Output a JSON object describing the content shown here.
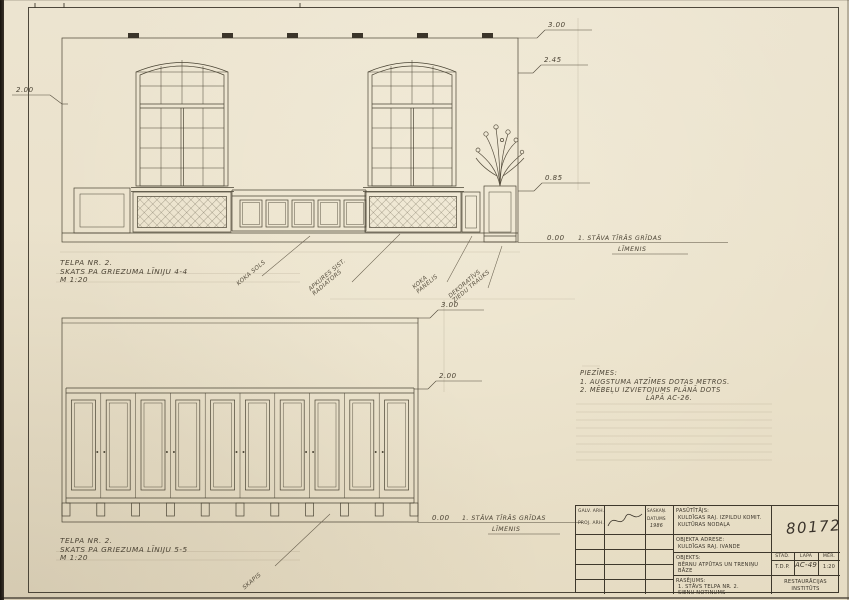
{
  "sheet": {
    "bg": "#ebe2cd",
    "ink": "#3e382c",
    "pencil": "#564e3e"
  },
  "top_view": {
    "title1": "TELPA NR. 2.",
    "title2": "SKATS PA GRIEZUMA LĪNIJU 4-4",
    "title3": "M 1:20",
    "lvl_top": "3.00",
    "lvl_lintel": "2.45",
    "lvl_sill": "0.85",
    "lvl_floor": "0.00",
    "lvl_left": "2.00",
    "floor_text": "1. STĀVA TĪRĀS GRĪDAS",
    "floor_text2": "LĪMENIS",
    "callout1": "KOKA SOLS",
    "callout2a": "APKURES SIST.",
    "callout2b": "RADIATORS",
    "callout3a": "KOKA",
    "callout3b": "PANELIS",
    "callout4a": "DEKORATĪVS",
    "callout4b": "ZIEDU TRAUKS"
  },
  "bottom_view": {
    "title1": "TELPA NR. 2.",
    "title2": "SKATS PA GRIEZUMA LĪNIJU 5-5",
    "title3": "M 1:20",
    "lvl_top": "3.00",
    "lvl_cab": "2.00",
    "lvl_floor": "0.00",
    "floor_text": "1. STĀVA TĪRĀS GRĪDAS",
    "floor_text2": "LĪMENIS",
    "callout": "SKAPIS"
  },
  "notes": {
    "heading": "PIEZĪMES:",
    "n1": "1. AUGSTUMA ATZĪMES DOTAS METROS.",
    "n2": "2. MĒBEĻU IZVIETOJUMS PLĀNĀ DOTS",
    "n3": "LAPĀ AC-26."
  },
  "titleblock": {
    "role1": "GALV. ARH.",
    "role2": "PROJ. ARH.",
    "approve1": "SASKAŅ.",
    "approve2": "DATUMS",
    "year": "1986",
    "client_label": "PASŪTĪTĀJS:",
    "client1": "KULDĪGAS RAJ. IZPILDU KOMIT.",
    "client2": "KULTŪRAS NODAĻA",
    "addr_label": "OBJEKTA ADRESE:",
    "addr1": "KULDĪGAS RAJ. IVANDE",
    "obj_label": "OBJEKTS:",
    "obj1": "BĒRNU ATPŪTAS UN TRENIŅU",
    "obj2": "BĀZE",
    "dwg_label": "RASĒJUMS:",
    "dwg1": "1. STĀVS TELPA NR. 2.",
    "dwg2": "SIENU NOTINUMS",
    "org1": "RESTAURĀCIJAS",
    "org2": "INSTITŪTS",
    "h_stage": "STAD.",
    "h_sheet": "LAPA",
    "h_scale": "MĒR.",
    "v_stage": "T.D.P.",
    "v_sheet": "AC-49",
    "v_scale": "1:20",
    "doc_no": "80172"
  }
}
